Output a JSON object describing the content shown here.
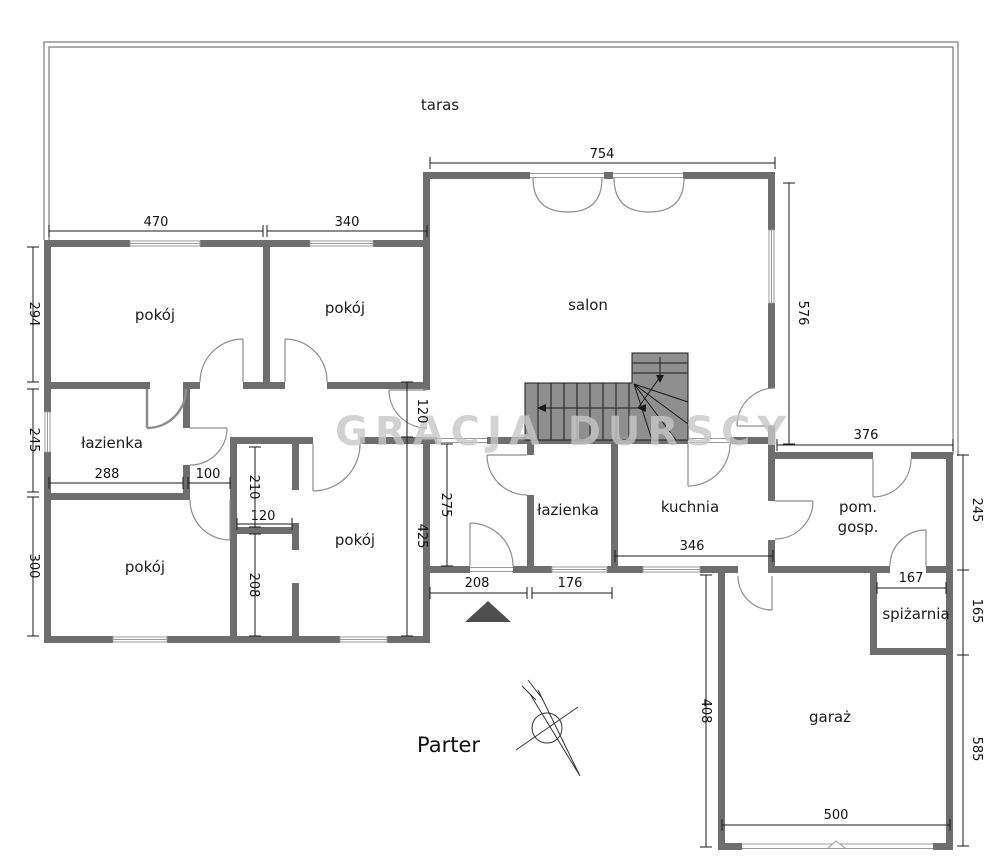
{
  "floor_plan": {
    "title": "Parter",
    "watermark": "GRACJA DURSCY",
    "rooms": [
      {
        "id": "taras",
        "label": "taras"
      },
      {
        "id": "pokoj-top-left",
        "label": "pokój"
      },
      {
        "id": "pokoj-top-mid",
        "label": "pokój"
      },
      {
        "id": "salon",
        "label": "salon"
      },
      {
        "id": "lazienka-left",
        "label": "łazienka"
      },
      {
        "id": "pokoj-bottom-left",
        "label": "pokój"
      },
      {
        "id": "pokoj-bottom-mid",
        "label": "pokój"
      },
      {
        "id": "lazienka-center",
        "label": "łazienka"
      },
      {
        "id": "kuchnia",
        "label": "kuchnia"
      },
      {
        "id": "pom-gosp",
        "line1": "pom.",
        "line2": "gosp."
      },
      {
        "id": "spizarnia",
        "label": "spiżarnia"
      },
      {
        "id": "garaz",
        "label": "garaż"
      }
    ],
    "dimensions_cm": [
      {
        "id": "top-left-room-width",
        "value": "470"
      },
      {
        "id": "top-mid-room-width",
        "value": "340"
      },
      {
        "id": "salon-width",
        "value": "754"
      },
      {
        "id": "salon-height",
        "value": "576"
      },
      {
        "id": "top-left-room-depth",
        "value": "294"
      },
      {
        "id": "bathroom-left-depth",
        "value": "245"
      },
      {
        "id": "bottom-left-room-depth",
        "value": "300"
      },
      {
        "id": "bathroom-left-width",
        "value": "288"
      },
      {
        "id": "passage-width",
        "value": "100"
      },
      {
        "id": "closet-upper-depth",
        "value": "210"
      },
      {
        "id": "closet-width",
        "value": "120"
      },
      {
        "id": "closet-lower-depth",
        "value": "208"
      },
      {
        "id": "corridor-door-width",
        "value": "120"
      },
      {
        "id": "bottom-mid-room-depth",
        "value": "425"
      },
      {
        "id": "hall-depth",
        "value": "275"
      },
      {
        "id": "hall-width",
        "value": "208"
      },
      {
        "id": "bathroom-center-width",
        "value": "176"
      },
      {
        "id": "kitchen-width",
        "value": "346"
      },
      {
        "id": "utility-width",
        "value": "376"
      },
      {
        "id": "utility-depth",
        "value": "245"
      },
      {
        "id": "pantry-width",
        "value": "167"
      },
      {
        "id": "pantry-depth",
        "value": "165"
      },
      {
        "id": "garage-side-left",
        "value": "585"
      },
      {
        "id": "garage-depth",
        "value": "408"
      },
      {
        "id": "garage-width",
        "value": "500"
      }
    ]
  }
}
